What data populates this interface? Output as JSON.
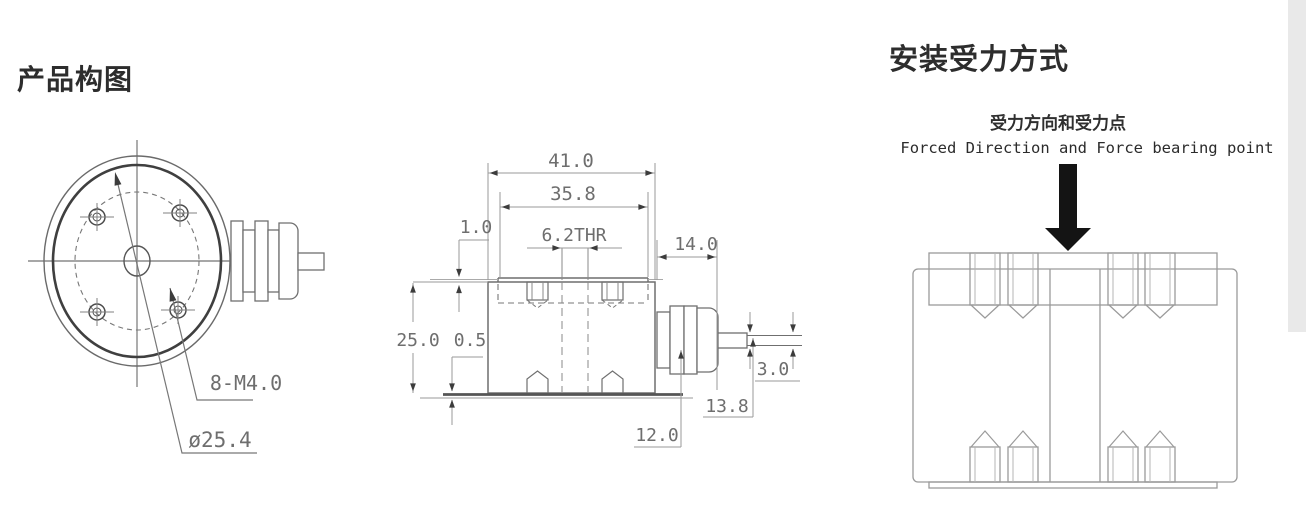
{
  "page": {
    "background": "#ffffff",
    "right_strip_color": "#e9e9e9"
  },
  "left_section": {
    "title": "产品构图",
    "front_view": {
      "labels": {
        "bolt_pattern": "8-M4.0",
        "bolt_circle_diameter": "ø25.4"
      }
    },
    "side_view": {
      "dims": {
        "overall_width": "41.0",
        "plate_width": "35.8",
        "plate_step": "1.0",
        "center_hole": "6.2THR",
        "connector_length": "14.0",
        "body_height": "25.0",
        "base_step": "0.5",
        "cable_diameter": "3.0",
        "cable_top_offset": "13.8",
        "cable_center_offset": "12.0"
      }
    }
  },
  "right_section": {
    "title": "安装受力方式",
    "caption_zh": "受力方向和受力点",
    "caption_en": "Forced Direction and Force bearing point"
  },
  "colors": {
    "heading": "#2d2d2d",
    "drawing_line": "#6f6f6f",
    "drawing_line_dark": "#3f3f3f",
    "drawing_line_light": "#9a9a9a",
    "dimension_text": "#6e6e6e",
    "arrow_fill": "#3c3c3c",
    "force_arrow": "#141414"
  }
}
